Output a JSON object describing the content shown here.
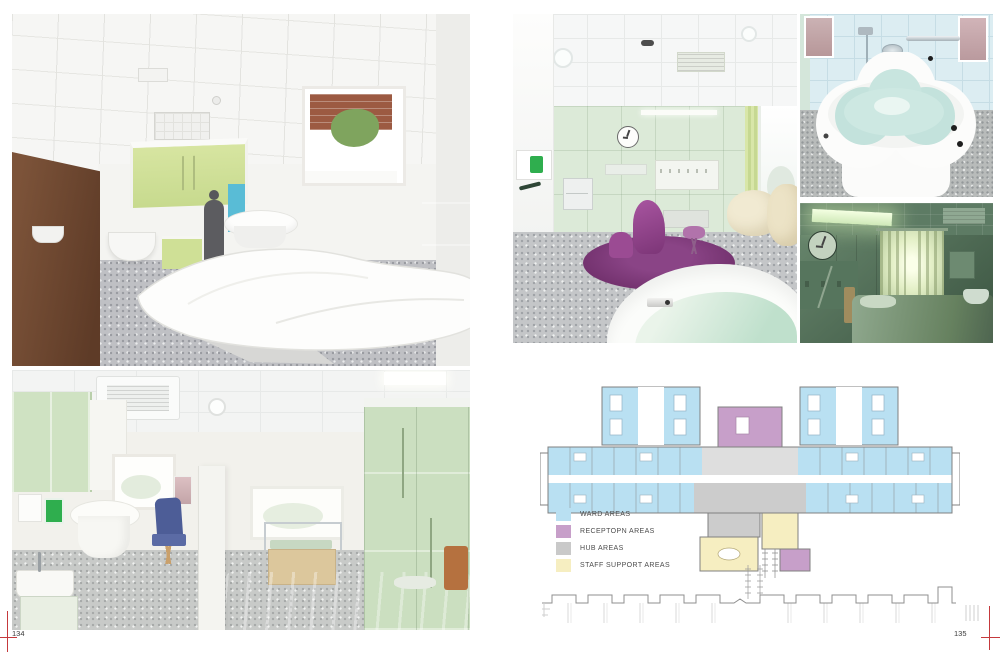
{
  "folios": {
    "left": "134",
    "right": "135"
  },
  "legend": {
    "items": [
      {
        "label": "WARD AREAS",
        "color": "#b9e0f2"
      },
      {
        "label": "RECEPTOPN AREAS",
        "color": "#c79fc9"
      },
      {
        "label": "HUB AREAS",
        "color": "#c9c9c9"
      },
      {
        "label": "STAFF SUPPORT AREAS",
        "color": "#f6eec1"
      }
    ]
  },
  "plan": {
    "ward_color": "#b9e0f2",
    "reception_color": "#c79fc9",
    "hub_color": "#c9c9c9",
    "staff_color": "#f6eec1",
    "wall_color": "#808080"
  },
  "colors": {
    "crop_mark": "#c5393c",
    "accent_green_dispenser": "#2fae4e"
  }
}
